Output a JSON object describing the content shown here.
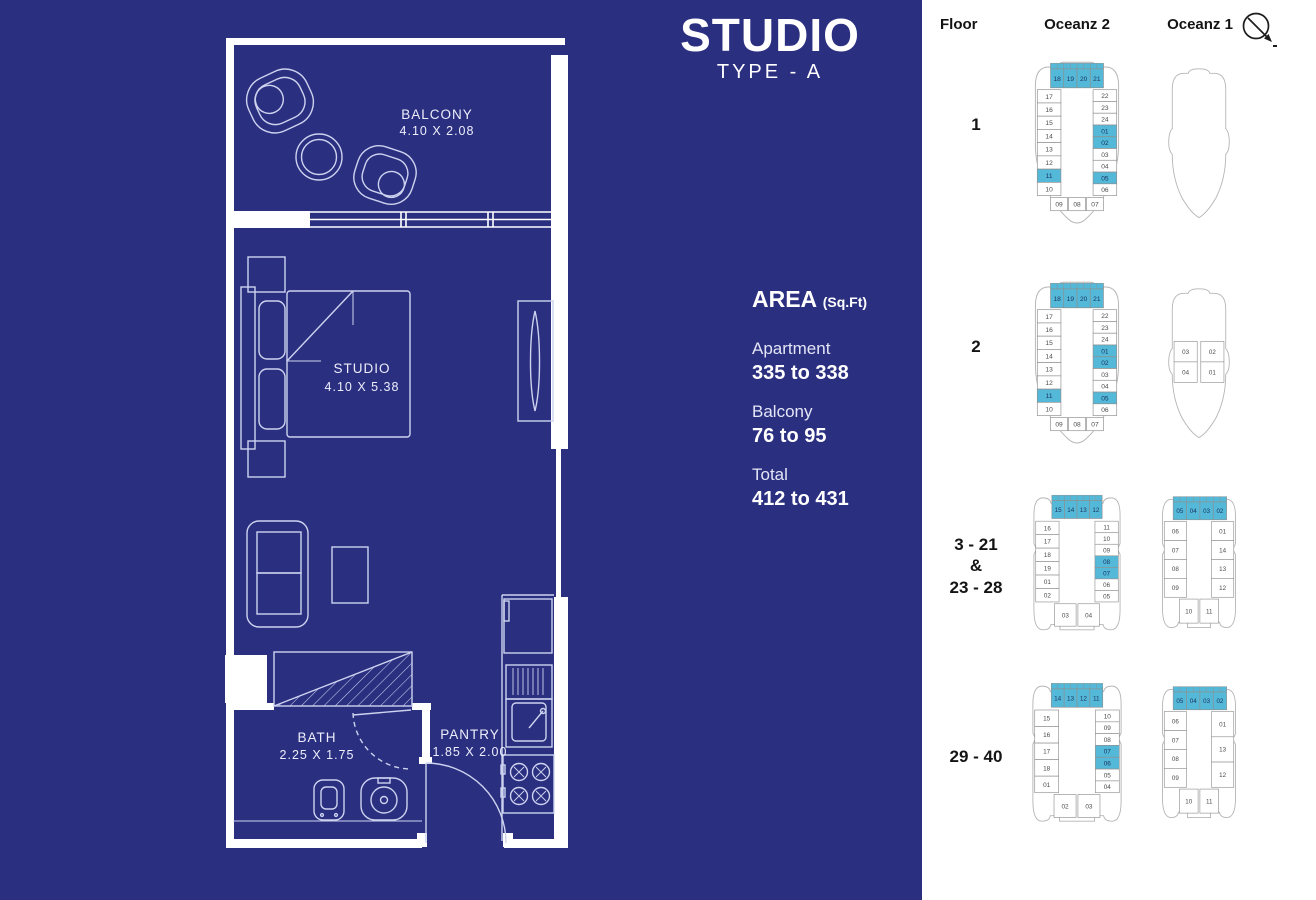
{
  "colors": {
    "background": "#2b2f80",
    "highlight": "#54b9d8",
    "plan_line": "#8f8f8f",
    "wall": "#ffffff"
  },
  "title": {
    "main": "STUDIO",
    "sub": "TYPE - A"
  },
  "area": {
    "heading": "AREA",
    "unit": "(Sq.Ft)",
    "items": [
      {
        "label": "Apartment",
        "value": "335 to 338"
      },
      {
        "label": "Balcony",
        "value": "76 to 95"
      },
      {
        "label": "Total",
        "value": "412 to 431"
      }
    ]
  },
  "floorplan": {
    "rooms": [
      {
        "name": "BALCONY",
        "dims": "4.10 X 2.08"
      },
      {
        "name": "STUDIO",
        "dims": "4.10 X 5.38"
      },
      {
        "name": "BATH",
        "dims": "2.25 X 1.75"
      },
      {
        "name": "PANTRY",
        "dims": "1.85 X 2.00"
      }
    ]
  },
  "key_plans": {
    "headers": {
      "floor": "Floor",
      "oceanz2": "Oceanz 2",
      "oceanz1": "Oceanz 1"
    },
    "compass_icon": "north-arrow",
    "rows": [
      {
        "floor_lines": [
          "1"
        ],
        "oceanz2": {
          "hull": "o2-bow",
          "top": [
            {
              "n": "18",
              "hl": true
            },
            {
              "n": "19",
              "hl": true
            },
            {
              "n": "20",
              "hl": true
            },
            {
              "n": "21",
              "hl": true
            }
          ],
          "left": [
            {
              "n": "17"
            },
            {
              "n": "16"
            },
            {
              "n": "15"
            },
            {
              "n": "14"
            },
            {
              "n": "13"
            },
            {
              "n": "12"
            },
            {
              "n": "11",
              "hl": true
            },
            {
              "n": "10"
            }
          ],
          "right": [
            {
              "n": "22"
            },
            {
              "n": "23"
            },
            {
              "n": "24"
            },
            {
              "n": "01",
              "hl": true
            },
            {
              "n": "02",
              "hl": true
            },
            {
              "n": "03"
            },
            {
              "n": "04"
            },
            {
              "n": "05",
              "hl": true
            },
            {
              "n": "06"
            }
          ],
          "bottom": [
            {
              "n": "09"
            },
            {
              "n": "08"
            },
            {
              "n": "07"
            }
          ]
        },
        "oceanz1": {
          "hull": "o1-bow",
          "top": [],
          "left": [],
          "right": [],
          "bottom": []
        }
      },
      {
        "floor_lines": [
          "2"
        ],
        "oceanz2": {
          "hull": "o2-bow",
          "top": [
            {
              "n": "18",
              "hl": true
            },
            {
              "n": "19",
              "hl": true
            },
            {
              "n": "20",
              "hl": true
            },
            {
              "n": "21",
              "hl": true
            }
          ],
          "left": [
            {
              "n": "17"
            },
            {
              "n": "16"
            },
            {
              "n": "15"
            },
            {
              "n": "14"
            },
            {
              "n": "13"
            },
            {
              "n": "12"
            },
            {
              "n": "11",
              "hl": true
            },
            {
              "n": "10"
            }
          ],
          "right": [
            {
              "n": "22"
            },
            {
              "n": "23"
            },
            {
              "n": "24"
            },
            {
              "n": "01",
              "hl": true
            },
            {
              "n": "02",
              "hl": true
            },
            {
              "n": "03"
            },
            {
              "n": "04"
            },
            {
              "n": "05",
              "hl": true
            },
            {
              "n": "06"
            }
          ],
          "bottom": [
            {
              "n": "09"
            },
            {
              "n": "08"
            },
            {
              "n": "07"
            }
          ]
        },
        "oceanz1": {
          "hull": "o1-bow",
          "top": [],
          "left": [
            {
              "n": "03"
            },
            {
              "n": "04"
            }
          ],
          "right": [
            {
              "n": "02"
            },
            {
              "n": "01"
            }
          ],
          "bottom": []
        }
      },
      {
        "floor_lines": [
          "3  - 21",
          "&",
          "23 - 28"
        ],
        "oceanz2": {
          "hull": "o2-full",
          "top": [
            {
              "n": "15",
              "hl": true
            },
            {
              "n": "14",
              "hl": true
            },
            {
              "n": "13",
              "hl": true
            },
            {
              "n": "12",
              "hl": true
            }
          ],
          "left": [
            {
              "n": "16"
            },
            {
              "n": "17"
            },
            {
              "n": "18"
            },
            {
              "n": "19"
            },
            {
              "n": "01"
            },
            {
              "n": "02"
            }
          ],
          "right": [
            {
              "n": "11"
            },
            {
              "n": "10"
            },
            {
              "n": "09"
            },
            {
              "n": "08",
              "hl": true
            },
            {
              "n": "07",
              "hl": true
            },
            {
              "n": "06"
            },
            {
              "n": "05"
            }
          ],
          "bottom": [
            {
              "n": "03"
            },
            {
              "n": "04"
            }
          ]
        },
        "oceanz1": {
          "hull": "o1-full",
          "top": [
            {
              "n": "05",
              "hl": true
            },
            {
              "n": "04",
              "hl": true
            },
            {
              "n": "03",
              "hl": true
            },
            {
              "n": "02",
              "hl": true
            }
          ],
          "left": [
            {
              "n": "06"
            },
            {
              "n": "07"
            },
            {
              "n": "08"
            },
            {
              "n": "09"
            }
          ],
          "right": [
            {
              "n": "01"
            },
            {
              "n": "14"
            },
            {
              "n": "13"
            },
            {
              "n": "12"
            }
          ],
          "bottom": [
            {
              "n": "10"
            },
            {
              "n": "11"
            }
          ]
        }
      },
      {
        "floor_lines": [
          "29 - 40"
        ],
        "oceanz2": {
          "hull": "o2-full",
          "top": [
            {
              "n": "14",
              "hl": true
            },
            {
              "n": "13",
              "hl": true
            },
            {
              "n": "12",
              "hl": true
            },
            {
              "n": "11",
              "hl": true
            }
          ],
          "left": [
            {
              "n": "15"
            },
            {
              "n": "16"
            },
            {
              "n": "17"
            },
            {
              "n": "18"
            },
            {
              "n": "01"
            }
          ],
          "right": [
            {
              "n": "10"
            },
            {
              "n": "09"
            },
            {
              "n": "08"
            },
            {
              "n": "07",
              "hl": true
            },
            {
              "n": "06",
              "hl": true
            },
            {
              "n": "05"
            },
            {
              "n": "04"
            }
          ],
          "bottom": [
            {
              "n": "02"
            },
            {
              "n": "03"
            }
          ]
        },
        "oceanz1": {
          "hull": "o1-full",
          "top": [
            {
              "n": "05",
              "hl": true
            },
            {
              "n": "04",
              "hl": true
            },
            {
              "n": "03",
              "hl": true
            },
            {
              "n": "02",
              "hl": true
            }
          ],
          "left": [
            {
              "n": "06"
            },
            {
              "n": "07"
            },
            {
              "n": "08"
            },
            {
              "n": "09"
            }
          ],
          "right": [
            {
              "n": "01"
            },
            {
              "n": "13"
            },
            {
              "n": "12"
            }
          ],
          "bottom": [
            {
              "n": "10"
            },
            {
              "n": "11"
            }
          ]
        }
      }
    ]
  }
}
